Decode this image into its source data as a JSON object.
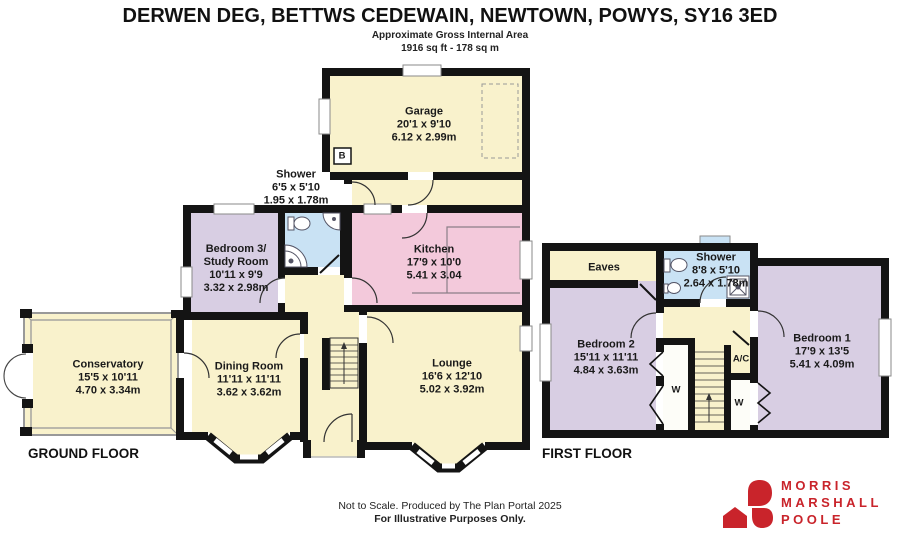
{
  "header": {
    "title": "DERWEN DEG, BETTWS CEDEWAIN, NEWTOWN, POWYS, SY16 3ED",
    "subtitle1": "Approximate Gross Internal Area",
    "subtitle2": "1916 sq ft - 178 sq m"
  },
  "ground_floor": {
    "label": "GROUND FLOOR",
    "rooms": {
      "garage": {
        "name": "Garage",
        "dims_ft": "20'1 x 9'10",
        "dims_m": "6.12 x 2.99m"
      },
      "shower": {
        "name": "Shower",
        "dims_ft": "6'5 x 5'10",
        "dims_m": "1.95 x 1.78m"
      },
      "bedroom3": {
        "name_line1": "Bedroom 3/",
        "name_line2": "Study Room",
        "dims_ft": "10'11 x 9'9",
        "dims_m": "3.32 x 2.98m"
      },
      "kitchen": {
        "name": "Kitchen",
        "dims_ft": "17'9 x 10'0",
        "dims_m": "5.41 x 3.04"
      },
      "conservatory": {
        "name": "Conservatory",
        "dims_ft": "15'5 x 10'11",
        "dims_m": "4.70 x 3.34m"
      },
      "dining": {
        "name": "Dining Room",
        "dims_ft": "11'11 x 11'11",
        "dims_m": "3.62 x 3.62m"
      },
      "lounge": {
        "name": "Lounge",
        "dims_ft": "16'6 x 12'10",
        "dims_m": "5.02 x 3.92m"
      },
      "boiler": "B"
    }
  },
  "first_floor": {
    "label": "FIRST FLOOR",
    "rooms": {
      "eaves": {
        "name": "Eaves"
      },
      "shower": {
        "name": "Shower",
        "dims_ft": "8'8 x 5'10",
        "dims_m": "2.64 x 1.78m"
      },
      "bedroom2": {
        "name": "Bedroom 2",
        "dims_ft": "15'11 x 11'11",
        "dims_m": "4.84 x 3.63m"
      },
      "bedroom1": {
        "name": "Bedroom 1",
        "dims_ft": "17'9 x 13'5",
        "dims_m": "5.41 x 4.09m"
      },
      "airing_cupboard": "A/C",
      "wardrobe_left": "W",
      "wardrobe_right": "W"
    }
  },
  "footer": {
    "line1": "Not to Scale. Produced by The Plan Portal 2025",
    "line2": "For Illustrative Purposes Only."
  },
  "logo": {
    "line1": "MORRIS",
    "line2": "MARSHALL",
    "line3": "POOLE",
    "brand_color": "#C9242B"
  },
  "colors": {
    "room_cream": "#F9F2CC",
    "room_purple": "#D8CEE3",
    "room_pink": "#F3C9DB",
    "room_blue": "#C9E2F4",
    "wall": "#141414"
  }
}
